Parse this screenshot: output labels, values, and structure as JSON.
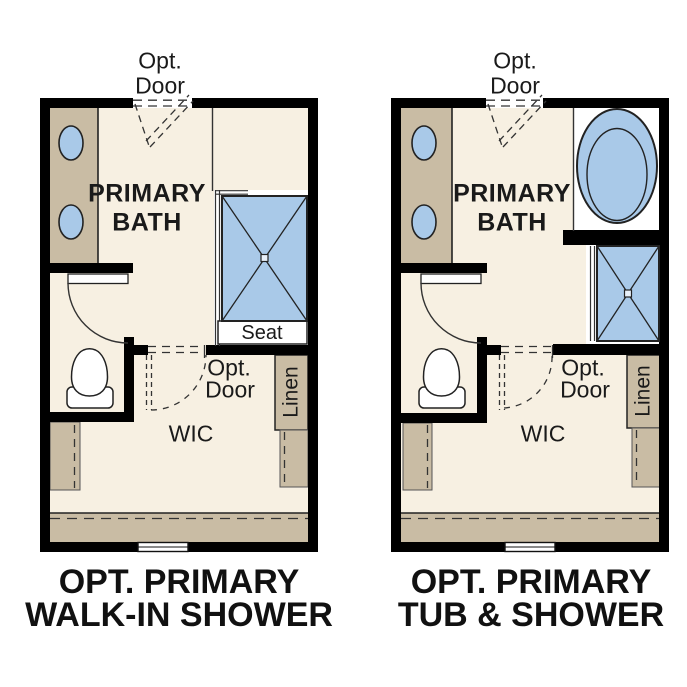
{
  "figure": {
    "type": "floor-plan-options",
    "colors": {
      "wall": "#000000",
      "floor": "#f7f0e2",
      "cabinet": "#c9bca4",
      "fixture_blue": "#a9c9e8",
      "line": "#222222"
    }
  },
  "plans": [
    {
      "id": "walk-in-shower",
      "title": [
        "OPT. PRIMARY",
        "WALK-IN SHOWER"
      ],
      "room": [
        "PRIMARY",
        "BATH"
      ],
      "top_door": [
        "Opt.",
        "Door"
      ],
      "wic_door": [
        "Opt.",
        "Door"
      ],
      "wic": "WIC",
      "linen": "Linen",
      "seat": "Seat"
    },
    {
      "id": "tub-and-shower",
      "title": [
        "OPT. PRIMARY",
        "TUB & SHOWER"
      ],
      "room": [
        "PRIMARY",
        "BATH"
      ],
      "top_door": [
        "Opt.",
        "Door"
      ],
      "wic_door": [
        "Opt.",
        "Door"
      ],
      "wic": "WIC",
      "linen": "Linen"
    }
  ]
}
